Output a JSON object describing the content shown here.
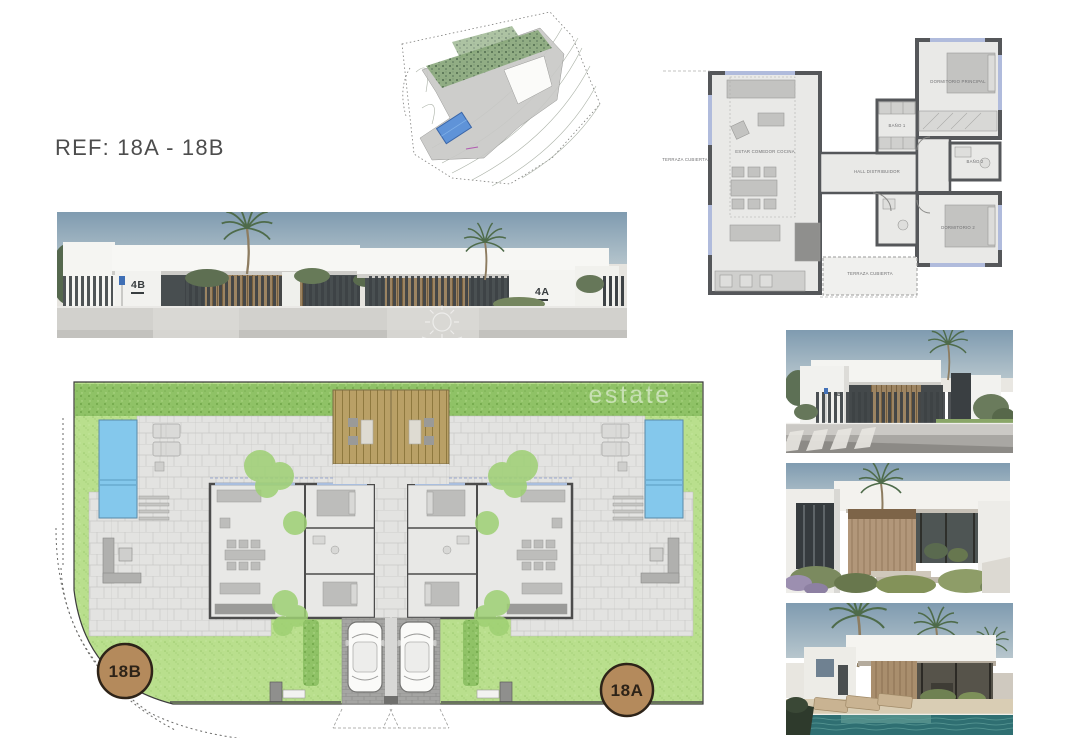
{
  "page": {
    "ref_label": "REF: 18A - 18B",
    "background": "#ffffff"
  },
  "location_map": {
    "plot_highlight_color": "#5f93d8"
  },
  "floor_plan": {
    "labels": {
      "terrace_left": "TERRAZA CUBIERTA",
      "living": "ESTAR COMEDOR COCINA",
      "hall": "HALL DISTRIBUIDOR",
      "bedroom_main": "DORMITORIO PRINCIPAL",
      "bath_1": "BAÑO 1",
      "bath_2": "BAÑO 2",
      "bedroom_2": "DORMITORIO 2",
      "terrace_bottom": "TERRAZA CUBIERTA"
    }
  },
  "elevation": {
    "house_left_number": "4B",
    "house_right_number": "4A"
  },
  "site_plan": {
    "badge_left": "18B",
    "badge_right": "18A",
    "watermark": "estate",
    "badge_fill": "#b48a5c",
    "pool_fill": "#84c8ec",
    "lawn_fill": "#b9df8d",
    "deck_fill": "#b9a066"
  },
  "photos": {
    "street_house_number": "4B"
  }
}
